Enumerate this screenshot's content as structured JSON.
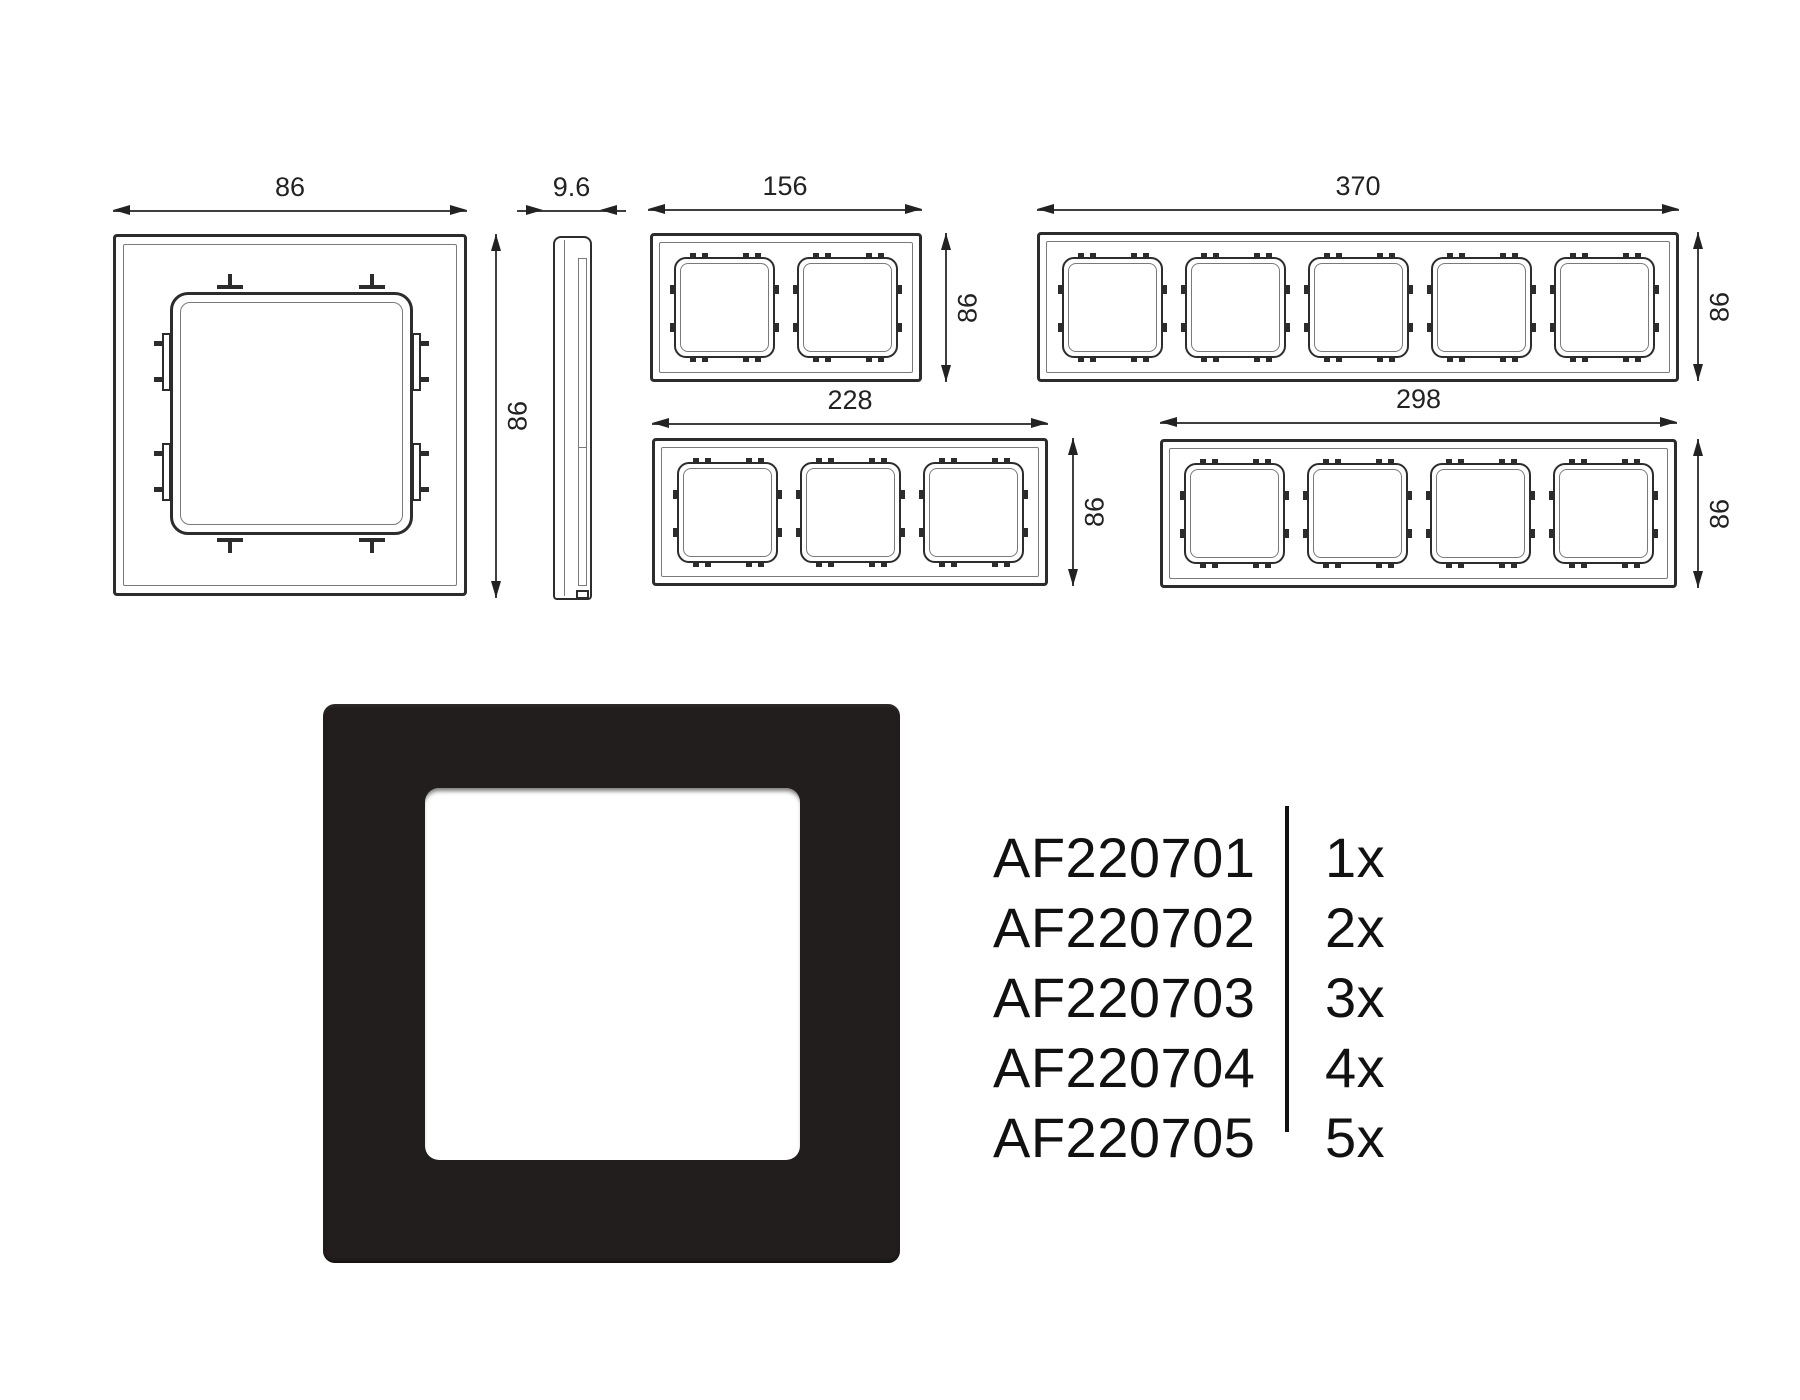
{
  "drawings": {
    "detail": {
      "width_label": "86",
      "height_label": "86"
    },
    "side": {
      "width_label": "9.6"
    },
    "frames": [
      {
        "id": "2-gang",
        "width_label": "156",
        "height_label": "86",
        "gangs": 2
      },
      {
        "id": "5-gang",
        "width_label": "370",
        "height_label": "86",
        "gangs": 5
      },
      {
        "id": "3-gang",
        "width_label": "228",
        "height_label": "86",
        "gangs": 3
      },
      {
        "id": "4-gang",
        "width_label": "298",
        "height_label": "86",
        "gangs": 4
      }
    ]
  },
  "part_list": [
    {
      "code": "AF220701",
      "qty": "1x"
    },
    {
      "code": "AF220702",
      "qty": "2x"
    },
    {
      "code": "AF220703",
      "qty": "3x"
    },
    {
      "code": "AF220704",
      "qty": "4x"
    },
    {
      "code": "AF220705",
      "qty": "5x"
    }
  ],
  "colors": {
    "frame_black": "#221e1d",
    "line_dark": "#2c2c2c"
  }
}
